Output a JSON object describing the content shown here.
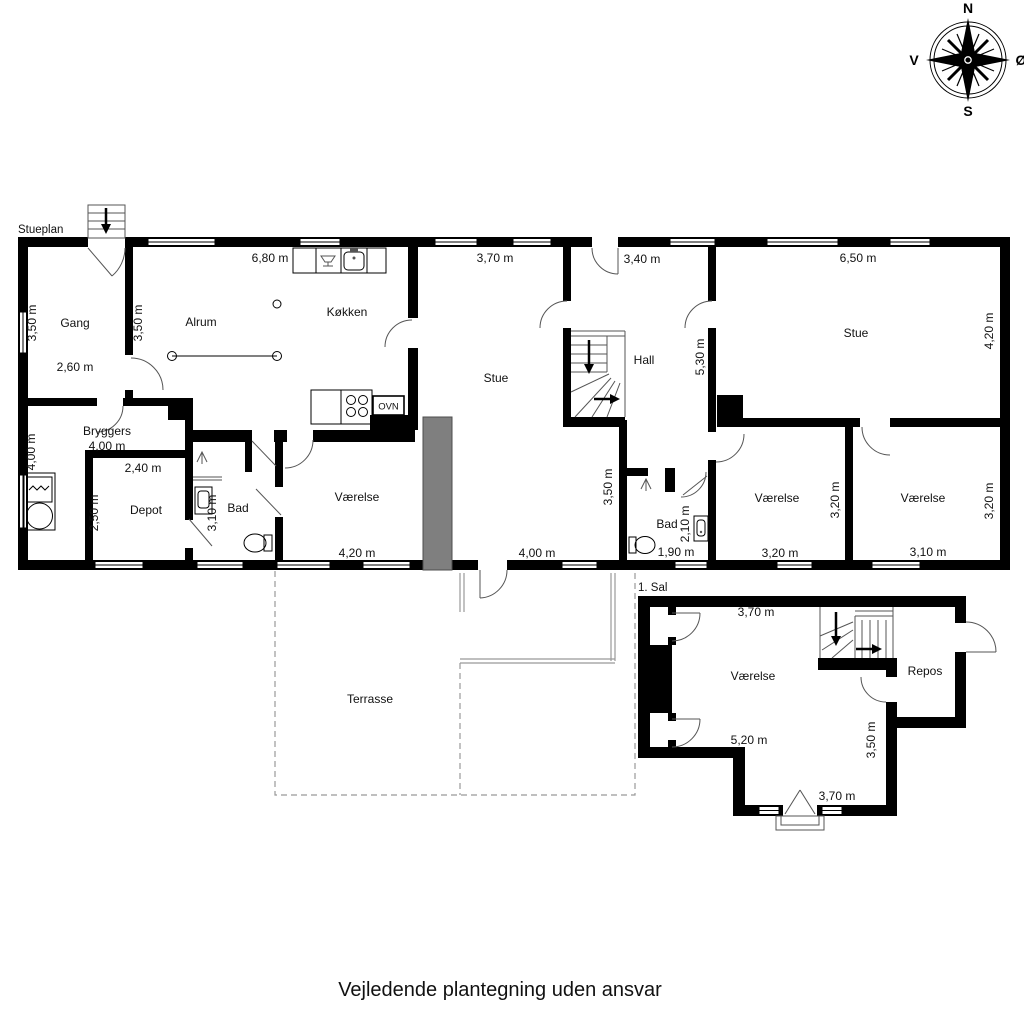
{
  "caption": "Vejledende plantegning uden ansvar",
  "compass": {
    "north": "N",
    "south": "S",
    "west": "V",
    "east": "Ø"
  },
  "ground_floor": {
    "label": "Stueplan",
    "rooms": {
      "gang": {
        "name": "Gang",
        "width": "2,60 m",
        "height": "3,50 m"
      },
      "alrum": {
        "name": "Alrum",
        "height": "3,50 m",
        "top_width": "6,80 m"
      },
      "kokken": {
        "name": "Køkken",
        "oven": "OVN"
      },
      "stue_mid": {
        "name": "Stue",
        "top_width": "3,70 m",
        "bottom_width": "4,00 m"
      },
      "hall": {
        "name": "Hall",
        "top_width": "3,40 m",
        "height": "5,30 m"
      },
      "stue_right": {
        "name": "Stue",
        "top_width": "6,50 m",
        "height": "4,20 m"
      },
      "bryggers": {
        "name": "Bryggers",
        "width": "4,00 m",
        "height": "4,00 m"
      },
      "depot": {
        "name": "Depot",
        "width": "2,40 m",
        "height": "2,50 m"
      },
      "bad_left": {
        "name": "Bad",
        "height": "3,10 m"
      },
      "vaerelse_left": {
        "name": "Værelse",
        "width": "4,20 m"
      },
      "bad_mid": {
        "name": "Bad",
        "width": "1,90 m",
        "height": "2,10 m",
        "wall_height": "3,50 m"
      },
      "vaerelse_mid": {
        "name": "Værelse",
        "width": "3,20 m",
        "height": "3,20 m"
      },
      "vaerelse_right": {
        "name": "Værelse",
        "width": "3,10 m",
        "height": "3,20 m"
      },
      "terrasse": {
        "name": "Terrasse"
      }
    }
  },
  "first_floor": {
    "label": "1. Sal",
    "rooms": {
      "vaerelse": {
        "name": "Værelse",
        "top_width": "3,70 m",
        "width": "5,20 m",
        "height": "3,50 m",
        "bottom_width": "3,70 m"
      },
      "repos": {
        "name": "Repos"
      }
    }
  }
}
